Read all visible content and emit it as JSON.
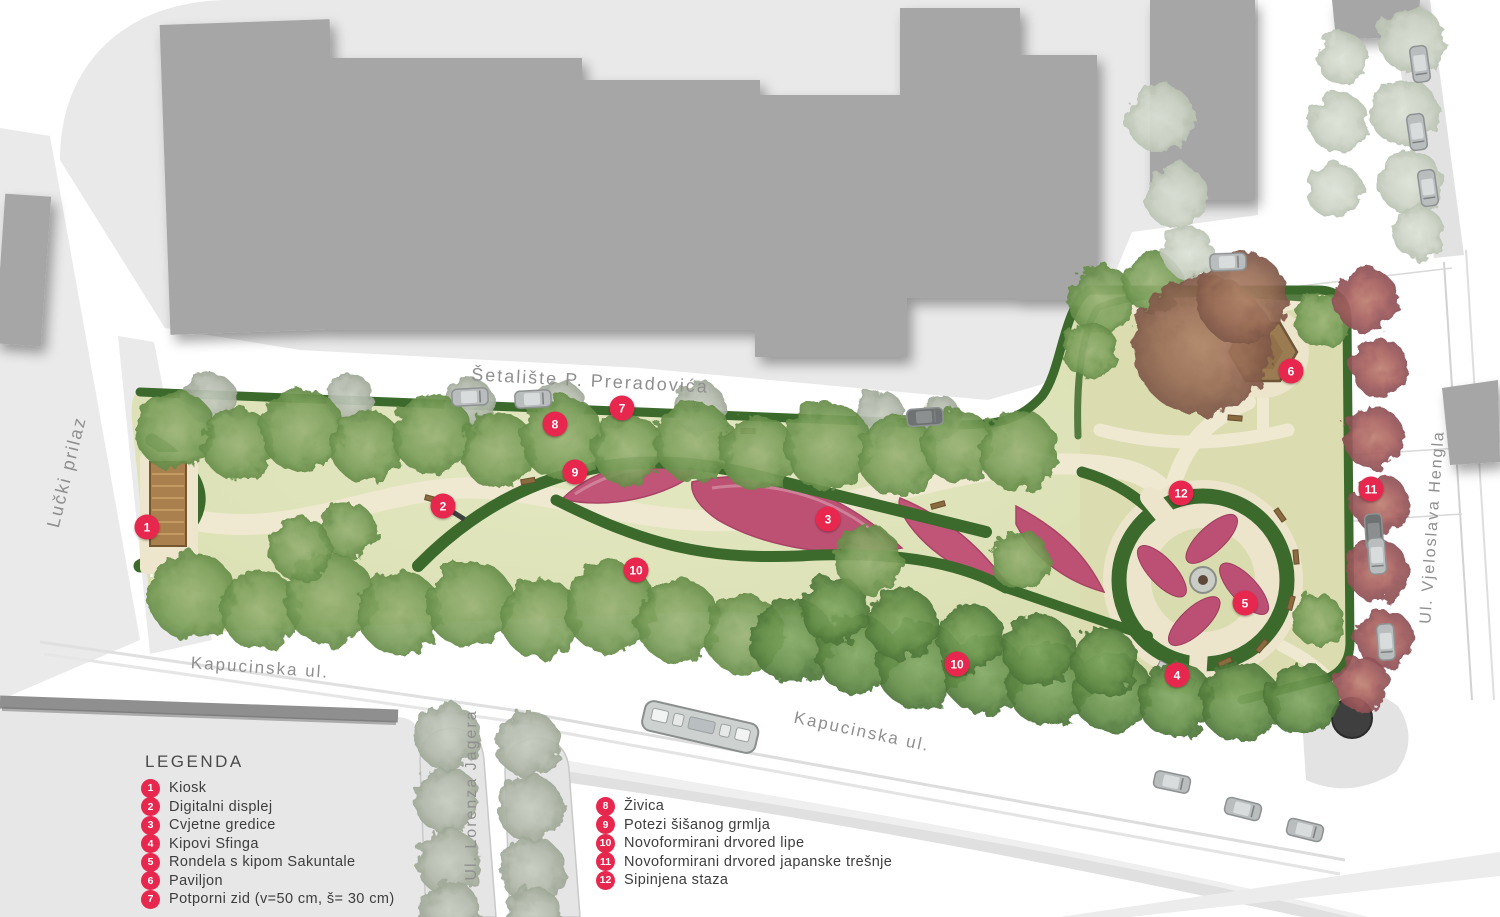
{
  "legend": {
    "title": "LEGENDA",
    "items": [
      {
        "num": "1",
        "label": "Kiosk"
      },
      {
        "num": "2",
        "label": "Digitalni displej"
      },
      {
        "num": "3",
        "label": "Cvjetne gredice"
      },
      {
        "num": "4",
        "label": "Kipovi Sfinga"
      },
      {
        "num": "5",
        "label": "Rondela s kipom Sakuntale"
      },
      {
        "num": "6",
        "label": "Paviljon"
      },
      {
        "num": "7",
        "label": "Potporni zid (v=50 cm, š= 30 cm)"
      },
      {
        "num": "8",
        "label": "Živica"
      },
      {
        "num": "9",
        "label": "Potezi šišanog grmlja"
      },
      {
        "num": "10",
        "label": "Novoformirani drvored lipe"
      },
      {
        "num": "11",
        "label": "Novoformirani drvored japanske trešnje"
      },
      {
        "num": "12",
        "label": "Sipinjena staza"
      }
    ]
  },
  "streets": [
    {
      "id": "setaliste",
      "label": "Šetalište P. Preradovića",
      "x": 590,
      "y": 381,
      "rot": 3,
      "size": 18
    },
    {
      "id": "lucki-prilaz",
      "label": "Lučki prilaz",
      "x": 67,
      "y": 472,
      "rot": -76,
      "size": 18
    },
    {
      "id": "kapucinska-west",
      "label": "Kapucinska ul.",
      "x": 260,
      "y": 668,
      "rot": 4,
      "size": 17
    },
    {
      "id": "kapucinska-east",
      "label": "Kapucinska ul.",
      "x": 862,
      "y": 732,
      "rot": 12,
      "size": 17
    },
    {
      "id": "lorenza-jagera",
      "label": "Ul. Lorenza Jagera",
      "x": 472,
      "y": 795,
      "rot": -90,
      "size": 16
    },
    {
      "id": "vjeloslava-hengla",
      "label": "Ul. Vjeloslava Hengla",
      "x": 1433,
      "y": 527,
      "rot": -86,
      "size": 16
    }
  ],
  "markers": [
    {
      "num": "1",
      "x": 147,
      "y": 527
    },
    {
      "num": "2",
      "x": 443,
      "y": 506
    },
    {
      "num": "3",
      "x": 828,
      "y": 519
    },
    {
      "num": "4",
      "x": 1177,
      "y": 675
    },
    {
      "num": "5",
      "x": 1245,
      "y": 603
    },
    {
      "num": "6",
      "x": 1291,
      "y": 371
    },
    {
      "num": "7",
      "x": 622,
      "y": 408
    },
    {
      "num": "8",
      "x": 555,
      "y": 424
    },
    {
      "num": "9",
      "x": 575,
      "y": 472
    },
    {
      "num": "10",
      "x": 636,
      "y": 570
    },
    {
      "num": "10",
      "x": 957,
      "y": 664
    },
    {
      "num": "11",
      "x": 1371,
      "y": 489
    },
    {
      "num": "12",
      "x": 1181,
      "y": 493
    }
  ],
  "colors": {
    "marker": "#e8274e",
    "lawn": "#dfe4bb",
    "hedge": "#3c6a2d",
    "path": "#efe9d2",
    "flowerbed": "#c05577",
    "building": "#a6a6a6",
    "street": "#e9e9e9"
  }
}
